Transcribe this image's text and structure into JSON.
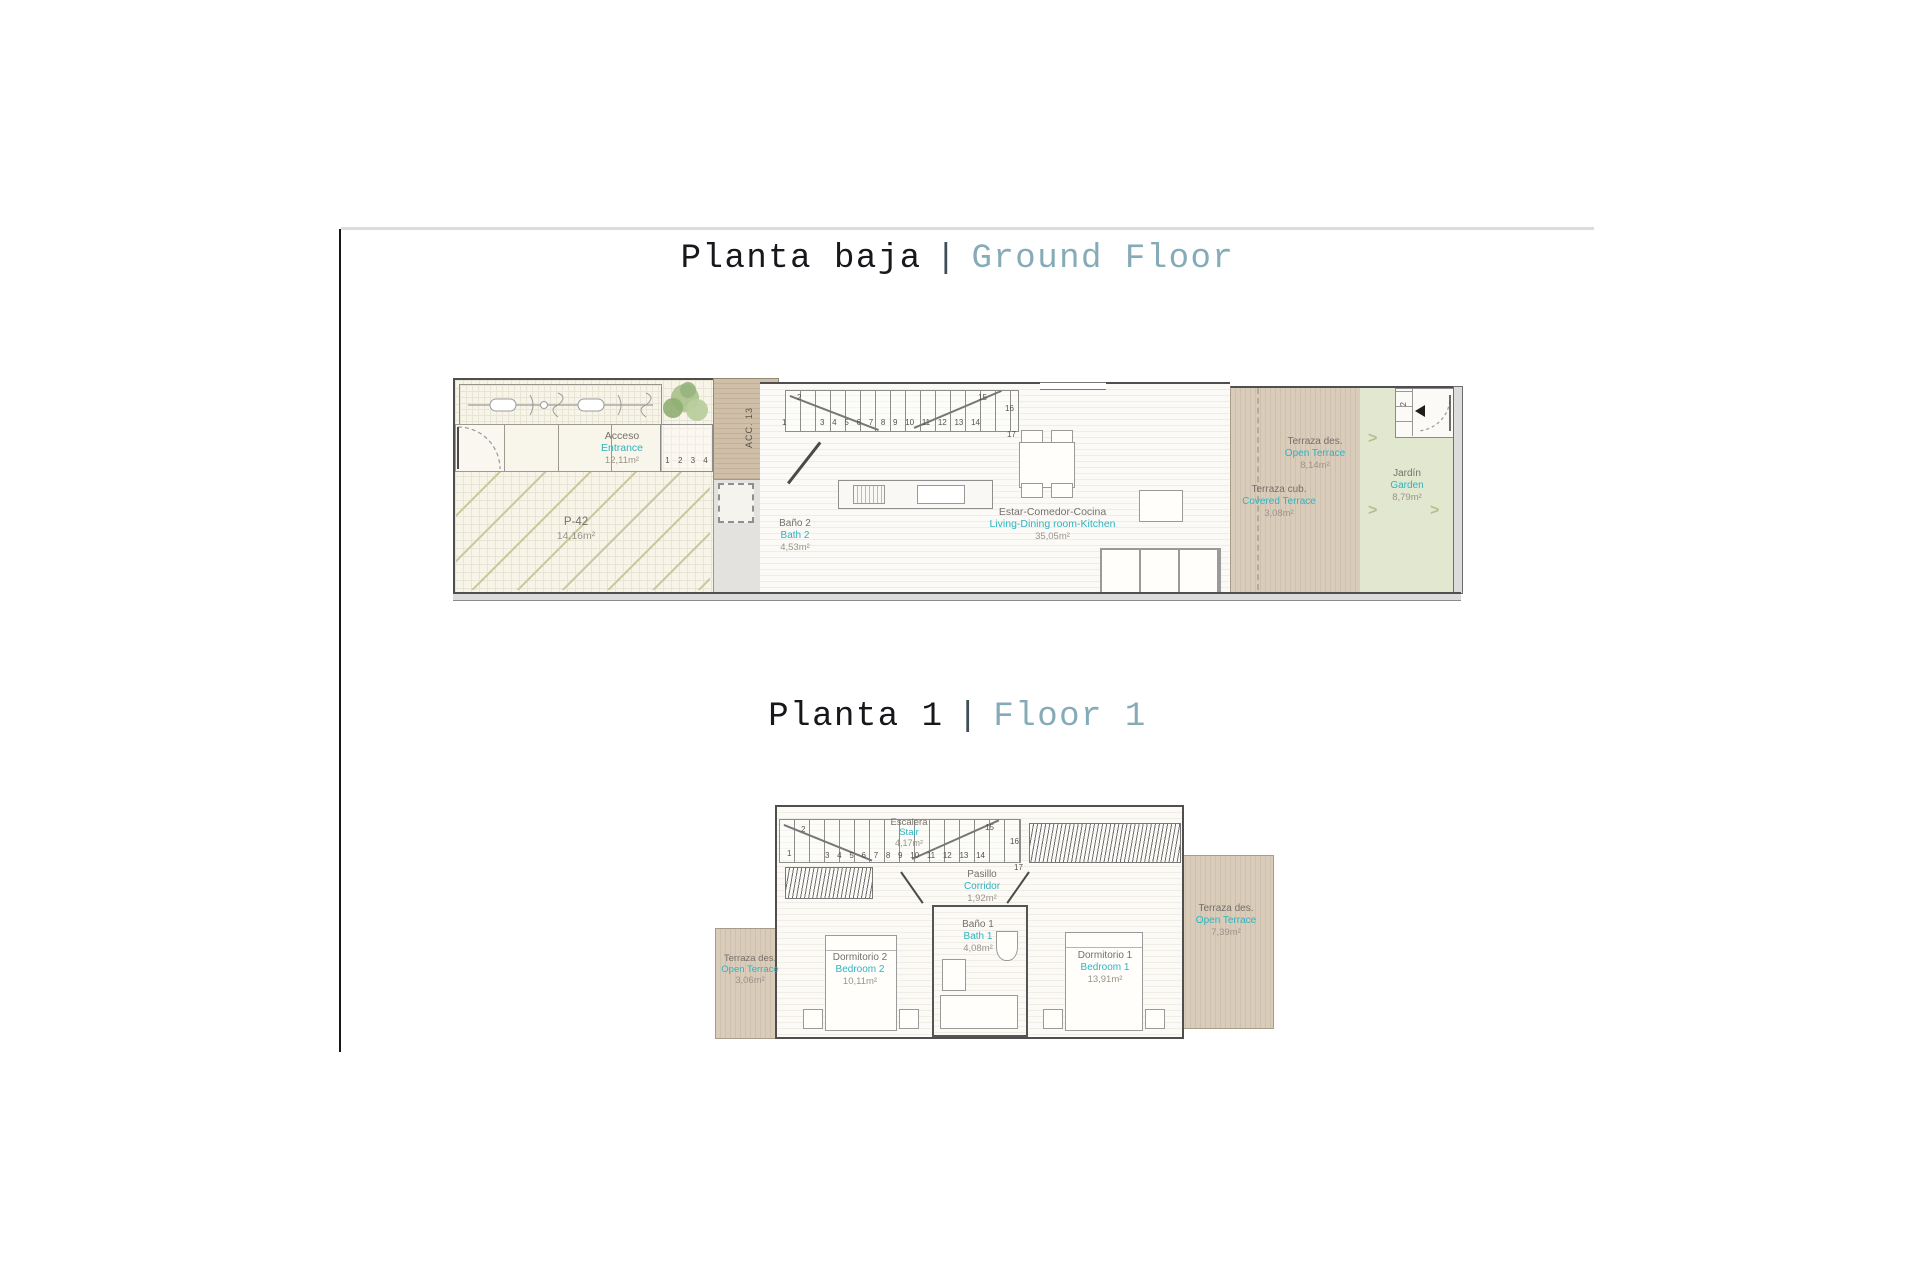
{
  "titles": {
    "ground_floor": {
      "name_es": "Planta baja",
      "divider": "|",
      "name_en": "Ground Floor"
    },
    "floor_1": {
      "name_es": "Planta 1",
      "divider": "|",
      "name_en": "Floor 1"
    }
  },
  "ground_floor": {
    "entrance": {
      "es": "Acceso",
      "en": "Entrance",
      "area": "12,11m²"
    },
    "parking": {
      "es": "P-42",
      "area": "14,16m²"
    },
    "access_corridor": {
      "label": "ACC. 13"
    },
    "entry_steps": "1 2 3 4",
    "bath2": {
      "es": "Baño 2",
      "en": "Bath 2",
      "area": "4,53m²"
    },
    "living": {
      "es": "Estar-Comedor-Cocina",
      "en": "Living-Dining room-Kitchen",
      "area": "35,05m²"
    },
    "covered_terrace": {
      "es": "Terraza cub.",
      "en": "Covered Terrace",
      "area": "3,08m²"
    },
    "open_terrace": {
      "es": "Terraza des.",
      "en": "Open Terrace",
      "area": "8,14m²"
    },
    "garden": {
      "es": "Jardín",
      "en": "Garden",
      "area": "8,79m²",
      "chevron": ">",
      "step": "2"
    },
    "stairs": {
      "n1": "1",
      "n2": "2",
      "row": "3 4 5 6 7 8 9 10 11 12 13 14",
      "n15": "15",
      "n16": "16",
      "n17": "17"
    }
  },
  "floor_1": {
    "stair": {
      "es": "Escalera",
      "en": "Stair",
      "area": "4,17m²"
    },
    "corridor": {
      "es": "Pasillo",
      "en": "Corridor",
      "area": "1,92m²"
    },
    "bath1": {
      "es": "Baño 1",
      "en": "Bath 1",
      "area": "4,08m²"
    },
    "bedroom2": {
      "es": "Dormitorio 2",
      "en": "Bedroom 2",
      "area": "10,11m²"
    },
    "bedroom1": {
      "es": "Dormitorio 1",
      "en": "Bedroom 1",
      "area": "13,91m²"
    },
    "terrace_left": {
      "es": "Terraza des.",
      "en": "Open Terrace",
      "area": "3,06m²"
    },
    "terrace_right": {
      "es": "Terraza des.",
      "en": "Open Terrace",
      "area": "7,39m²"
    },
    "stairs": {
      "n1": "1",
      "n2": "2",
      "row": "3 4 5 6 7 8 9 10 11 12 13 14",
      "n15": "15",
      "n16": "16",
      "n17": "17"
    }
  },
  "colors": {
    "accent_cyan": "#2FB3C2",
    "title_teal": "#85ABB8",
    "label_gray": "#75706A",
    "area_gray": "#9A948A",
    "deck_tan": "#D8CBB8",
    "garden_green": "#E2E7D0",
    "wall_gray": "#4F4F4F"
  }
}
